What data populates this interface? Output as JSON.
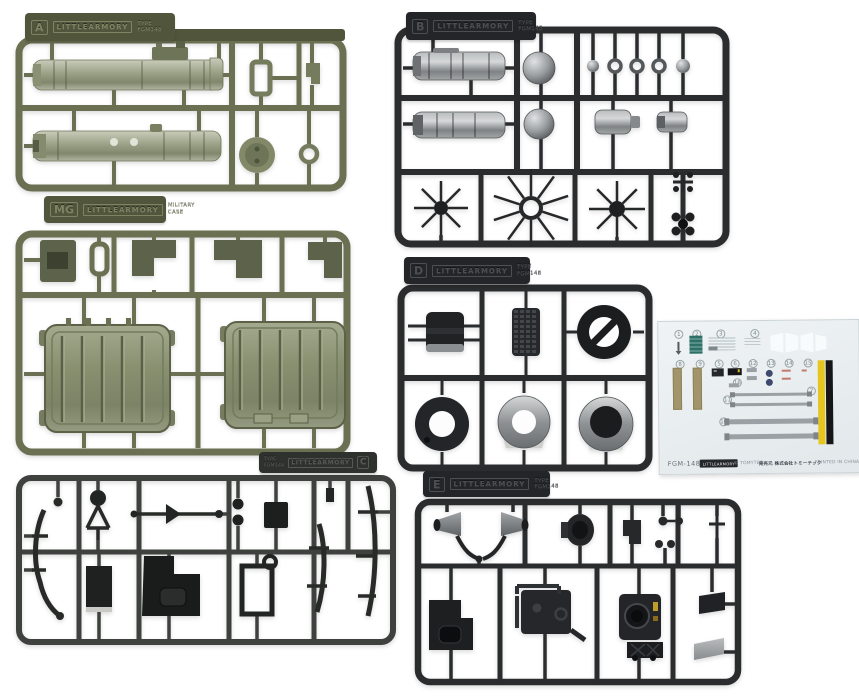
{
  "product": {
    "name": "FGM-148",
    "brand_logo": "LITTLEARMORY",
    "copyright": "© TOMYTEC",
    "distributor": "発売元 株式会社トミーテック",
    "printed": "PRINTED IN CHINA"
  },
  "sprues": {
    "a": {
      "letter": "A",
      "logo": "LITTLEARMORY",
      "sub1": "TYPE",
      "sub2": "FGM148",
      "plastic_color": "#6b7052"
    },
    "b": {
      "letter": "B",
      "logo": "LITTLEARMORY",
      "sub1": "TYPE",
      "sub2": "FGM148",
      "plastic_color": "#2a2c2e"
    },
    "mg": {
      "letter": "MG",
      "logo": "LITTLEARMORY",
      "sub1": "MILITARY",
      "sub2": "CASE",
      "plastic_color": "#6b7052"
    },
    "d": {
      "letter": "D",
      "logo": "LITTLEARMORY",
      "sub1": "TYPE",
      "sub2": "FGM148",
      "plastic_color": "#2a2c2e"
    },
    "c": {
      "letter": "C",
      "logo": "LITTLEARMORY",
      "sub1": "TYPE",
      "sub2": "FGM148",
      "plastic_color": "#3e413e"
    },
    "e": {
      "letter": "E",
      "logo": "LITTLEARMORY",
      "sub1": "TYPE",
      "sub2": "FGM148",
      "plastic_color": "#2a2c2e"
    }
  },
  "decal_sheet": {
    "part_name": "FGM-148",
    "logo": "LITTLEARMORY",
    "copyright": "© TOMYTEC",
    "distributor": "発売元 株式会社トミーテック",
    "printed": "PRINTED IN CHINA",
    "numbers": [
      "1",
      "2",
      "3",
      "4",
      "5",
      "6",
      "7",
      "8",
      "9",
      "10",
      "11",
      "12",
      "13",
      "14",
      "15",
      "16"
    ],
    "colors": {
      "sheet": "#e9eef0",
      "khaki_strip": "#a3956b",
      "yellow_stripe": "#e6c51f",
      "black_stripe": "#161618",
      "strap_gray": "#9aa0a3",
      "label_teal": "#2f6f66",
      "dot_blue": "#3d4a6d",
      "mark_red": "#c27a6d"
    }
  }
}
